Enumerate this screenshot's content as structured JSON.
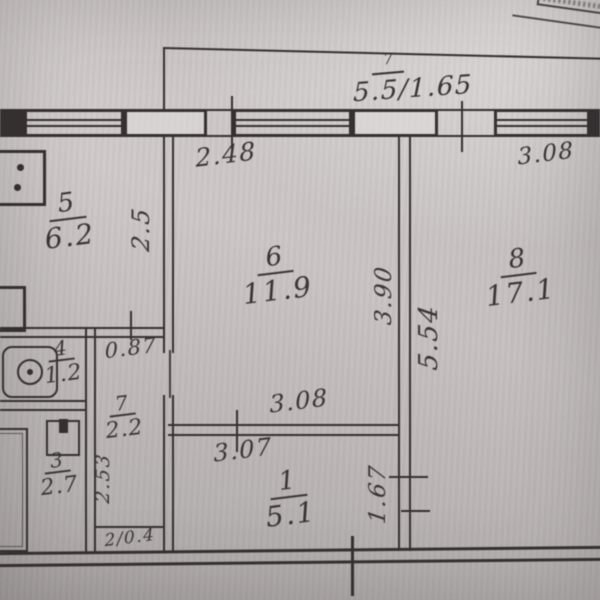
{
  "colors": {
    "paper": "#cac5c4",
    "ink": "#363031",
    "hand": "#3b3435"
  },
  "balcony": {
    "mark": "7",
    "label": "5.5/1.65"
  },
  "rooms": {
    "r1": {
      "num": "1",
      "area": "5.1"
    },
    "r3": {
      "num": "3",
      "area": "2.7"
    },
    "r4": {
      "num": "4",
      "area": "1.2"
    },
    "r5": {
      "num": "5",
      "area": "6.2"
    },
    "r6": {
      "num": "6",
      "area": "11.9"
    },
    "r7": {
      "num": "7",
      "area": "2.2"
    },
    "r8": {
      "num": "8",
      "area": "17.1"
    },
    "closet": {
      "label": "2/0.4"
    }
  },
  "dims": {
    "top_left": "2.48",
    "top_right": "3.08",
    "room5_depth": "2.5",
    "room6_depth": "3.90",
    "room8_depth": "5.54",
    "corridor_width": "0.87",
    "bath_depth": "2.53",
    "room1_width_top": "3.08",
    "room1_width_bottom": "3.07",
    "room1_depth": "1.67"
  }
}
